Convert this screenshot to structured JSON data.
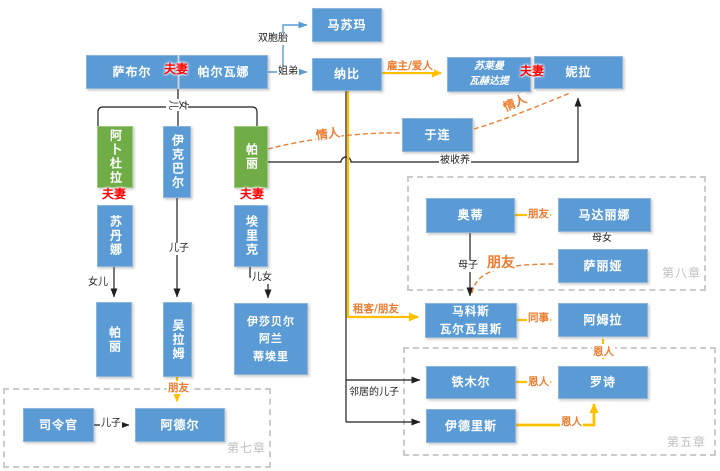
{
  "diagram": {
    "nodes": {
      "masooma": "马苏玛",
      "saboor": "萨布尔",
      "parwana": "帕尔瓦娜",
      "nabi": "纳比",
      "suleiman": "苏莱曼\n瓦赫达提",
      "nila": "妮拉",
      "julien": "于连",
      "abdullah": "阿卜杜拉",
      "iqbal": "伊克巴尔",
      "pari": "帕丽",
      "sultana": "苏丹娜",
      "eric": "埃里克",
      "pari_jr": "帕丽",
      "gholam": "吴拉姆",
      "isabelle": "伊莎贝尔\n阿兰\n蒂埃里",
      "commander": "司令官",
      "adel": "阿德尔",
      "odie": "奥蒂",
      "madaline": "马达丽娜",
      "thalia": "萨丽娅",
      "markos": "马科斯\n瓦尔瓦里斯",
      "amra": "阿姆拉",
      "timur": "铁木尔",
      "roshi": "罗诗",
      "idris": "伊德里斯"
    },
    "relations": {
      "couple1": "夫妻",
      "couple2": "夫妻",
      "couple3": "夫妻",
      "couple4": "夫妻",
      "twins": "双胞胎",
      "sister_brother": "姐弟",
      "children_top": "儿女",
      "employer_lover": "雇主/爱人",
      "lover1": "情人",
      "lover2": "情人",
      "adopted": "被收养",
      "son1": "儿子",
      "daughter": "女儿",
      "children2": "儿女",
      "friend_gholam": "朋友",
      "son2": "儿子",
      "friend_odie": "朋友",
      "mother_daughter": "母女",
      "mother_son": "母子",
      "friend_thalia": "朋友",
      "tenant_friend": "租客/朋友",
      "colleague": "同事",
      "benefactor1": "恩人",
      "benefactor2": "恩人",
      "benefactor3": "恩人",
      "neighbor_son": "邻居的儿子"
    },
    "chapters": {
      "ch7": "第七章",
      "ch8": "第八章",
      "ch5": "第五章"
    },
    "colors": {
      "node_blue": "#5B9BD5",
      "node_green": "#70AD47",
      "relation_orange": "#ED7D31",
      "arrow_yellow": "#FFC000",
      "couple_red": "#FF0000",
      "chapter_gray": "#BFBFBF"
    }
  }
}
